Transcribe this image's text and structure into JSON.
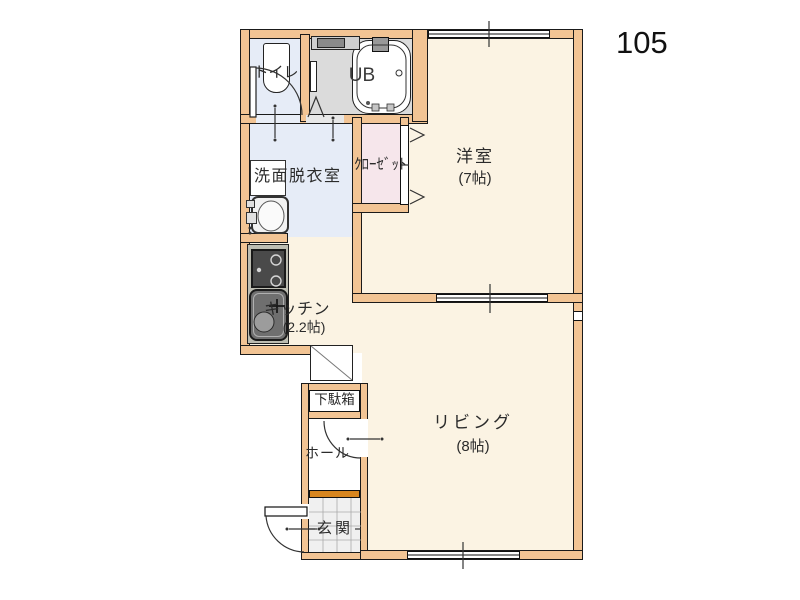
{
  "unit_number": "105",
  "rooms": {
    "western_room": {
      "name": "洋室",
      "size": "(7帖)"
    },
    "living": {
      "name": "リビング",
      "size": "(8帖)"
    },
    "kitchen": {
      "name": "キッチン",
      "size": "(2.2帖)"
    },
    "washroom": {
      "name": "洗面脱衣室"
    },
    "toilet": {
      "name": "トイレ"
    },
    "bath": {
      "name": "UB"
    },
    "closet": {
      "name": "ｸﾛｰｾﾞｯﾄ"
    },
    "shoe_cabinet": {
      "name": "下駄箱"
    },
    "hall": {
      "name": "ホール"
    },
    "entrance": {
      "name": "玄関"
    }
  },
  "colors": {
    "wall_fill": "#F2C494",
    "room_floor": "#FBF3E3",
    "wet_area_floor": "#E6ECF7",
    "closet_floor": "#F6E6EB",
    "bath_floor": "#DBDBDB",
    "entrance_step": "#D8861F",
    "entrance_tile": "#F0F0F0",
    "outline": "#1A1A1A"
  }
}
